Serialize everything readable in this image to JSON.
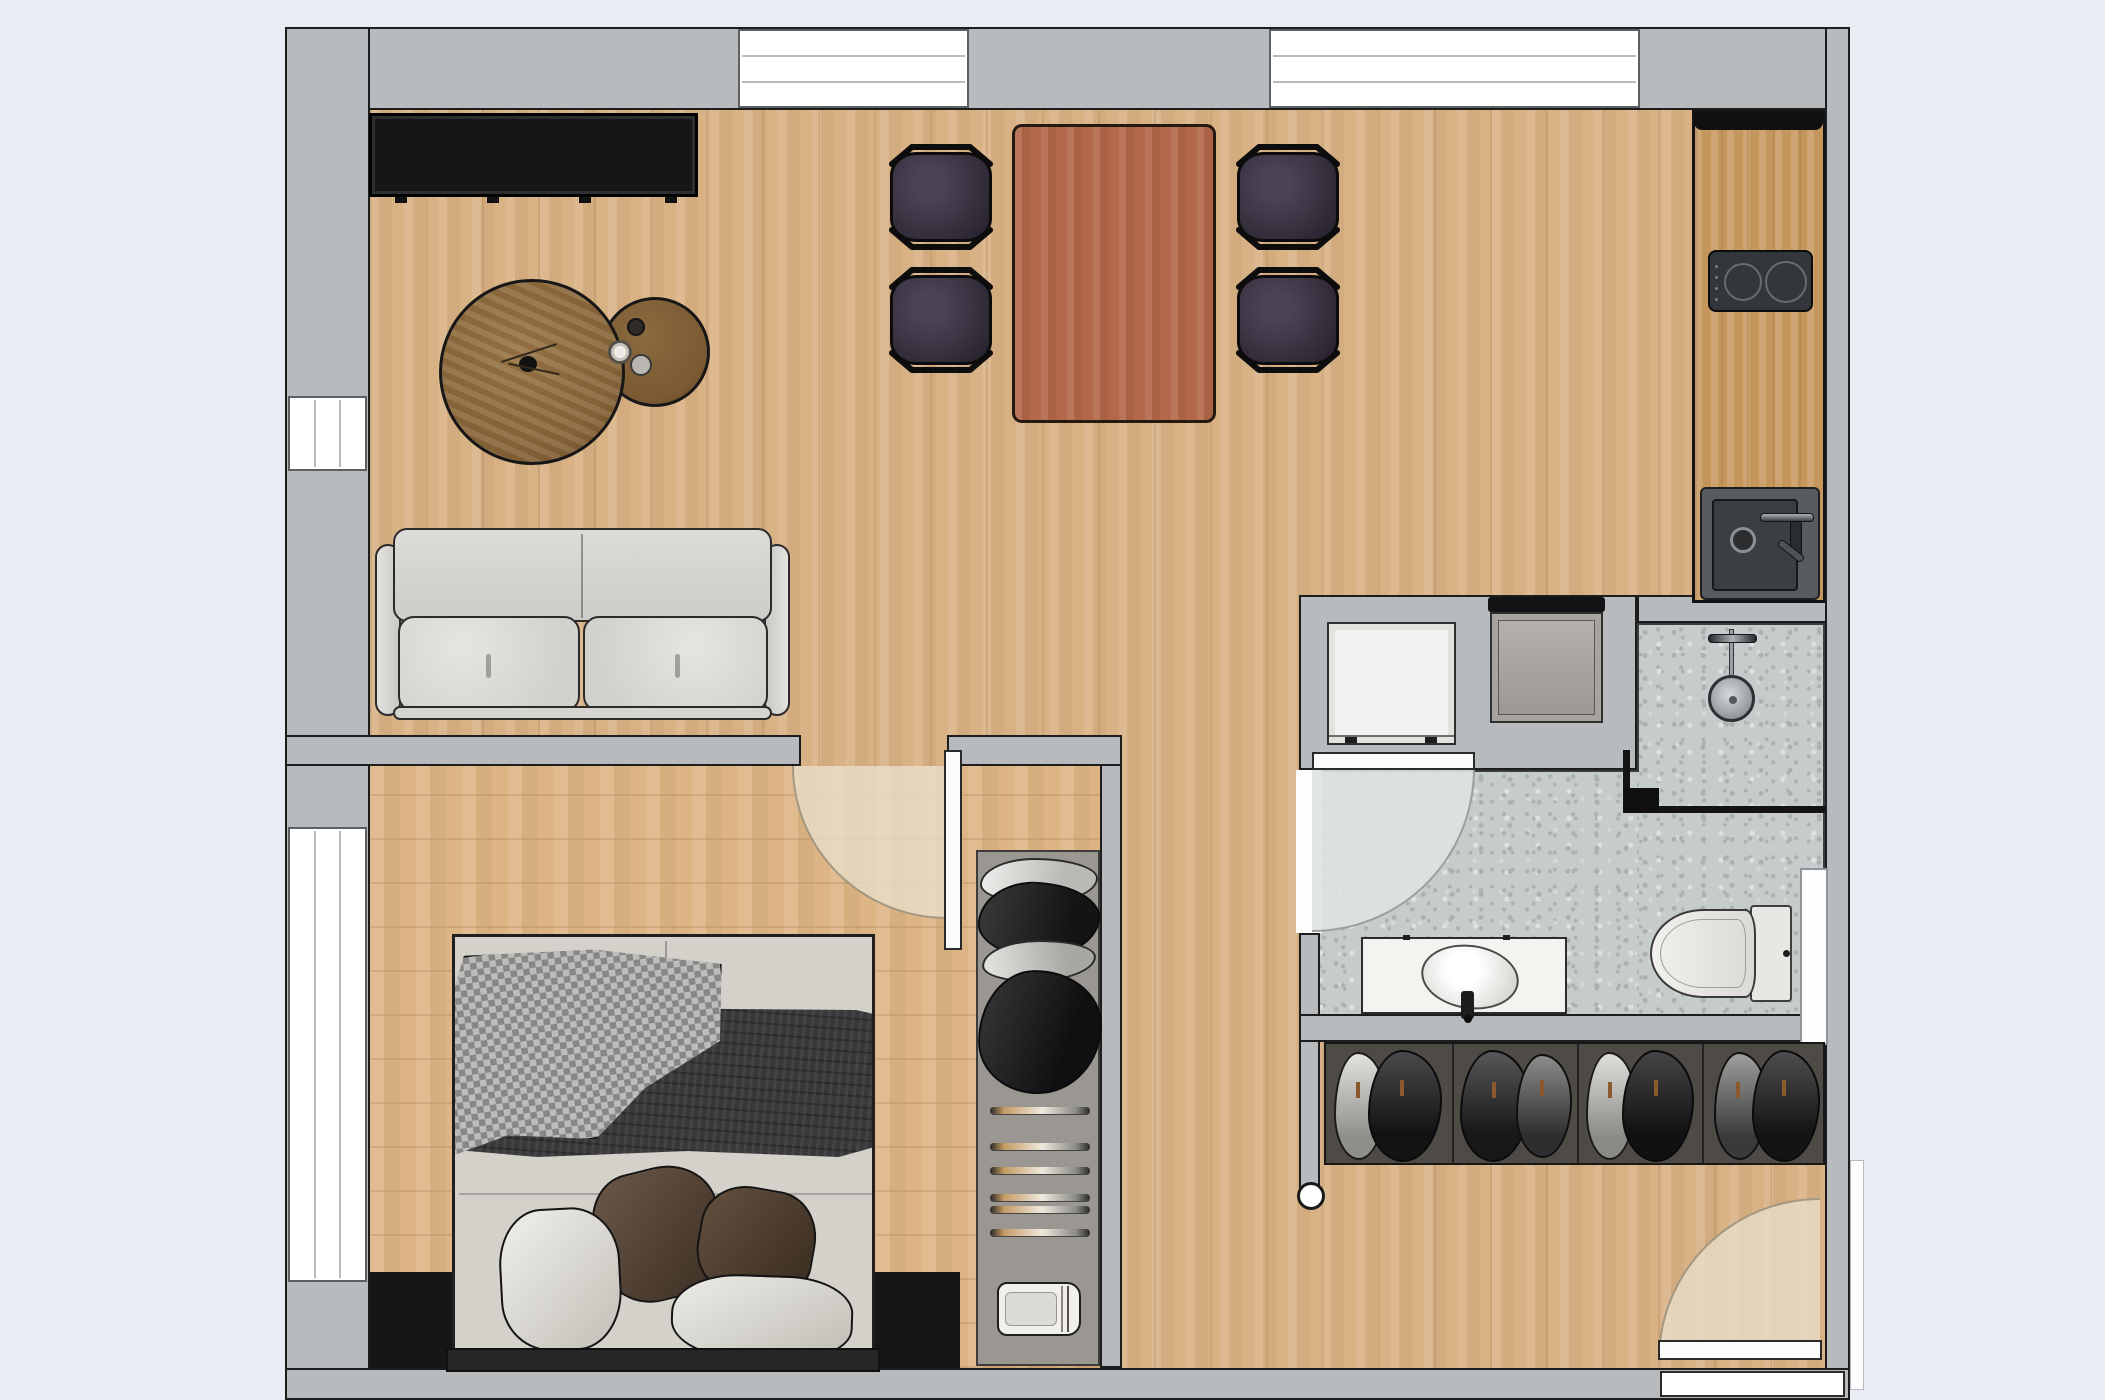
{
  "meta": {
    "type": "architectural-floor-plan",
    "view": "top-down",
    "visible_text_labels": []
  },
  "palette": {
    "bg": "#e9ecf2",
    "wall": "#b8bbbd",
    "wallLine": "#1d1d1d",
    "wood": "#d8b184",
    "woodBed": "#ddb584",
    "woodKitchen": "#c5965c",
    "tableWood": "#b3684a",
    "coffeeBig": "#8a673c",
    "coffeeSmall": "#7b5a33",
    "chairSeat": "#37313f",
    "console": "#161616",
    "sofaBody": "#d8d7d4",
    "mattress": "#d4d1cb",
    "blanket": "#39393b",
    "pillowWhite": "#e8e6e1",
    "pillowBrown": "#5f4c3c",
    "terrazzo": "#c6cccb",
    "terraDot": "#a9b2b1",
    "closetNiche": "#9a9792",
    "entryCloset": "#4e4b47",
    "washer": "#f2f1ef",
    "dryer": "#a7a4a0",
    "fixture": "#f4f3f0",
    "swingWood": "rgba(233,221,200,0.8)",
    "swingBath": "rgba(222,227,226,0.9)"
  },
  "floorplan": {
    "rooms": [
      {
        "name": "living-dining-area",
        "floor": "wood"
      },
      {
        "name": "bedroom",
        "floor": "wood"
      },
      {
        "name": "bathroom",
        "floor": "terrazzo"
      },
      {
        "name": "kitchenette",
        "floor": "wood"
      },
      {
        "name": "entry-hall",
        "floor": "wood"
      }
    ],
    "windows": [
      {
        "name": "window-top-left"
      },
      {
        "name": "window-top-right"
      },
      {
        "name": "window-left-upper"
      },
      {
        "name": "window-left-bedroom"
      }
    ],
    "doors": [
      {
        "name": "bedroom-door",
        "swing": "into-bedroom"
      },
      {
        "name": "bathroom-door",
        "swing": "into-bathroom"
      },
      {
        "name": "entry-door",
        "swing": "into-hall"
      }
    ],
    "furniture": [
      {
        "name": "tv-console"
      },
      {
        "name": "coffee-table-large"
      },
      {
        "name": "coffee-table-small"
      },
      {
        "name": "sofa",
        "seats": 2
      },
      {
        "name": "dining-table"
      },
      {
        "name": "dining-chair",
        "count": 4
      },
      {
        "name": "bed",
        "size": "double"
      },
      {
        "name": "bedroom-wardrobe",
        "contents": [
          "hanging-clothes",
          "empty-hangers",
          "folded-towels"
        ]
      },
      {
        "name": "entry-closet",
        "sections": 4
      },
      {
        "name": "kitchen-counter"
      },
      {
        "name": "cooktop",
        "burners": 2
      },
      {
        "name": "kitchen-sink"
      },
      {
        "name": "washing-machine"
      },
      {
        "name": "dryer"
      },
      {
        "name": "shower"
      },
      {
        "name": "vanity-sink"
      },
      {
        "name": "toilet"
      }
    ]
  }
}
